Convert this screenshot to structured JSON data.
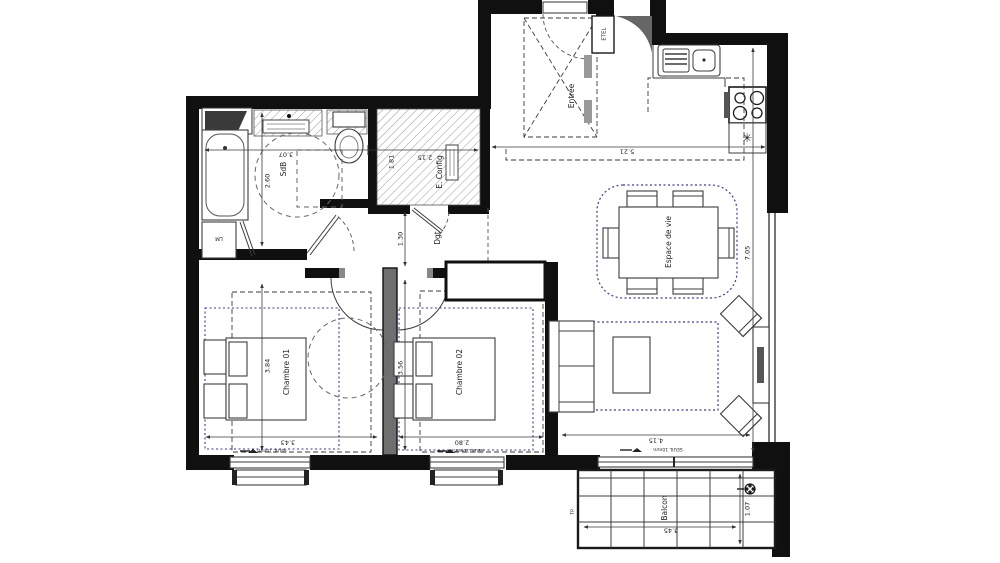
{
  "plan_title": "Apartment floor plan (2 bedrooms)",
  "rooms": {
    "sdb": {
      "label": "SdB",
      "dim_width_m": "3.07",
      "dim_height_m": "2.60"
    },
    "e_config": {
      "label": "E. Config",
      "dim_a_m": "1.81",
      "dim_b_m": "2.15"
    },
    "entree": {
      "label": "Entrée"
    },
    "etel": {
      "label": "ETEL"
    },
    "lm": {
      "label": "LM"
    },
    "dgt": {
      "label": "Dgt",
      "dim_width_m": "1.30"
    },
    "chambre1": {
      "label": "Chambre 01",
      "dim_width_m": "3.43",
      "dim_height_m": "3.84"
    },
    "chambre2": {
      "label": "Chambre 02",
      "dim_width_m": "2.80",
      "dim_height_m": "3.56"
    },
    "living": {
      "label": "Espace de vie",
      "dim_top_m": "5.21",
      "dim_bottom_m": "4.15",
      "dim_height_m": "7.05"
    },
    "balcon": {
      "label": "Balcon",
      "dim_width_m": "3.45",
      "dim_depth_m": "1.07",
      "tp_label": "TP"
    }
  },
  "annotations": {
    "seuil": "SEUIL 10mm"
  },
  "icons": {
    "fan": "✳"
  },
  "colors": {
    "wall": "#101010",
    "line": "#3c3c3c",
    "zone_dotted_blue": "#3b3b9a",
    "hatch": "#9a9a9a"
  }
}
